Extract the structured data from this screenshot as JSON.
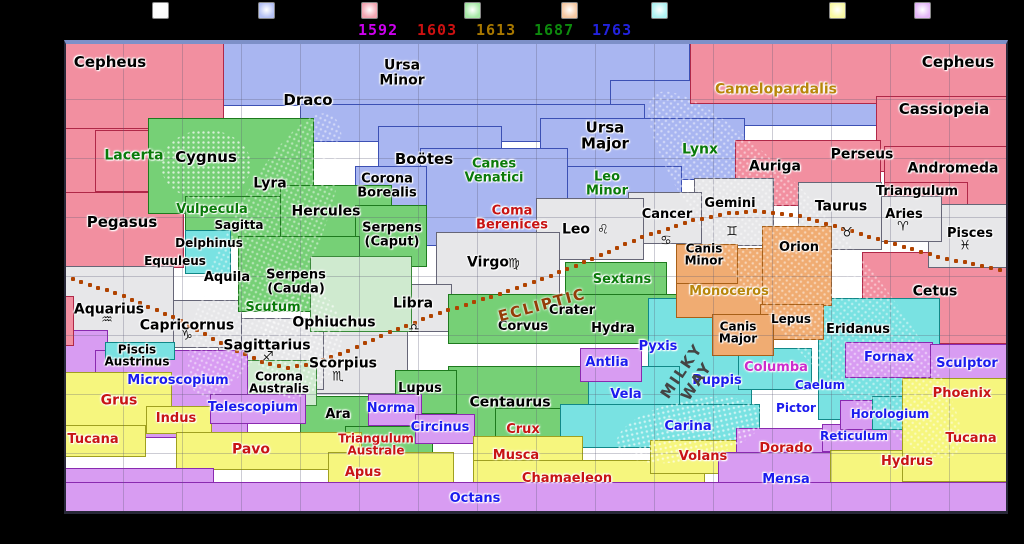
{
  "legend": {
    "swatches": [
      {
        "name": "zodiac-family",
        "color": "#fbfbfb",
        "x": 152
      },
      {
        "name": "ursa-major-family",
        "color": "#b4c0f4",
        "x": 258
      },
      {
        "name": "perseus-family",
        "color": "#f4a6b2",
        "x": 361
      },
      {
        "name": "hercules-family",
        "color": "#a6e8a6",
        "x": 464
      },
      {
        "name": "orion-family",
        "color": "#f6c8a2",
        "x": 561
      },
      {
        "name": "heavenly-waters-family",
        "color": "#aef2f2",
        "x": 651
      },
      {
        "name": "bayer-family",
        "color": "#f8f8a2",
        "x": 829
      },
      {
        "name": "lacaille-family",
        "color": "#e4b6f8",
        "x": 914
      }
    ],
    "years": [
      {
        "text": "1592",
        "color": "#cc00ee",
        "x": 358
      },
      {
        "text": "1603",
        "color": "#cc1111",
        "x": 417
      },
      {
        "text": "1613",
        "color": "#a87800",
        "x": 476
      },
      {
        "text": "1687",
        "color": "#0d8a0d",
        "x": 534
      },
      {
        "text": "1763",
        "color": "#2222dd",
        "x": 592
      }
    ]
  },
  "map": {
    "x": 64,
    "y": 40,
    "w": 944,
    "h": 474,
    "families": {
      "zodiac": {
        "fill": "#e7e7e9",
        "border": "#666677"
      },
      "ursa": {
        "fill": "#a9b6f1",
        "border": "#3c50b4"
      },
      "perseus": {
        "fill": "#f28fa0",
        "border": "#b02848"
      },
      "hercules": {
        "fill": "#76d076",
        "border": "#1e7a1e"
      },
      "herc2": {
        "fill": "#cfeacf",
        "border": "#3a8a3a"
      },
      "waters": {
        "fill": "#79e2e2",
        "border": "#118888"
      },
      "orion": {
        "fill": "#f0ac72",
        "border": "#a86018"
      },
      "bayer": {
        "fill": "#f6f67e",
        "border": "#a0a020"
      },
      "lacaille": {
        "fill": "#d89cf2",
        "border": "#8a2ab0"
      }
    },
    "label_colors": {
      "a": "#000000",
      "g": "#0a7a0a",
      "r": "#c81414",
      "t": "#b8860b",
      "m": "#cc2ccc",
      "b": "#1b1bee"
    },
    "regions": [
      [
        "ursa",
        222,
        42,
        468,
        64
      ],
      [
        "ursa",
        610,
        80,
        268,
        46
      ],
      [
        "ursa",
        300,
        104,
        345,
        38
      ],
      [
        "ursa",
        540,
        118,
        205,
        62
      ],
      [
        "ursa",
        560,
        166,
        122,
        44
      ],
      [
        "ursa",
        378,
        126,
        124,
        62
      ],
      [
        "ursa",
        420,
        148,
        148,
        98
      ],
      [
        "ursa",
        355,
        166,
        72,
        40
      ],
      [
        "perseus",
        64,
        42,
        160,
        94
      ],
      [
        "perseus",
        690,
        42,
        318,
        62
      ],
      [
        "perseus",
        64,
        128,
        96,
        74
      ],
      [
        "perseus",
        95,
        130,
        126,
        62
      ],
      [
        "perseus",
        64,
        192,
        120,
        76
      ],
      [
        "perseus",
        876,
        96,
        132,
        76
      ],
      [
        "perseus",
        735,
        140,
        146,
        66
      ],
      [
        "perseus",
        884,
        146,
        124,
        62
      ],
      [
        "perseus",
        884,
        182,
        84,
        28
      ],
      [
        "perseus",
        862,
        252,
        146,
        92
      ],
      [
        "zodiac",
        928,
        204,
        80,
        64
      ],
      [
        "zodiac",
        868,
        196,
        74,
        46
      ],
      [
        "zodiac",
        798,
        182,
        84,
        68
      ],
      [
        "zodiac",
        694,
        178,
        80,
        68
      ],
      [
        "zodiac",
        628,
        192,
        74,
        52
      ],
      [
        "zodiac",
        536,
        198,
        108,
        62
      ],
      [
        "zodiac",
        436,
        232,
        124,
        68
      ],
      [
        "zodiac",
        378,
        284,
        74,
        48
      ],
      [
        "zodiac",
        298,
        330,
        110,
        64
      ],
      [
        "zodiac",
        218,
        318,
        106,
        72
      ],
      [
        "zodiac",
        112,
        300,
        130,
        48
      ],
      [
        "zodiac",
        64,
        266,
        110,
        78
      ],
      [
        "hercules",
        148,
        118,
        166,
        96
      ],
      [
        "hercules",
        185,
        196,
        118,
        50
      ],
      [
        "hercules",
        280,
        185,
        112,
        96
      ],
      [
        "hercules",
        355,
        205,
        72,
        62
      ],
      [
        "hercules",
        238,
        236,
        122,
        76
      ],
      [
        "herc2",
        310,
        256,
        102,
        76
      ],
      [
        "hercules",
        565,
        262,
        102,
        42
      ],
      [
        "hercules",
        448,
        294,
        232,
        50
      ],
      [
        "hercules",
        448,
        366,
        170,
        72
      ],
      [
        "hercules",
        395,
        370,
        62,
        44
      ],
      [
        "hercules",
        300,
        396,
        82,
        54
      ],
      [
        "hercules",
        345,
        426,
        88,
        44
      ],
      [
        "herc2",
        245,
        360,
        72,
        46
      ],
      [
        "hercules",
        495,
        408,
        70,
        34
      ],
      [
        "waters",
        185,
        230,
        46,
        44
      ],
      [
        "waters",
        818,
        298,
        122,
        122
      ],
      [
        "waters",
        648,
        298,
        104,
        112
      ],
      [
        "waters",
        588,
        366,
        92,
        62
      ],
      [
        "waters",
        560,
        404,
        200,
        44
      ],
      [
        "waters",
        738,
        348,
        74,
        42
      ],
      [
        "orion",
        676,
        248,
        106,
        70
      ],
      [
        "orion",
        762,
        226,
        70,
        80
      ],
      [
        "orion",
        676,
        244,
        62,
        40
      ],
      [
        "orion",
        760,
        304,
        64,
        36
      ],
      [
        "orion",
        712,
        314,
        62,
        42
      ],
      [
        "lacaille",
        64,
        330,
        44,
        108
      ],
      [
        "lacaille",
        95,
        350,
        153,
        88
      ],
      [
        "waters",
        105,
        342,
        70,
        18
      ],
      [
        "bayer",
        64,
        372,
        108,
        55
      ],
      [
        "bayer",
        146,
        406,
        66,
        28
      ],
      [
        "bayer",
        64,
        425,
        82,
        32
      ],
      [
        "bayer",
        176,
        432,
        186,
        38
      ],
      [
        "lacaille",
        210,
        394,
        96,
        30
      ],
      [
        "lacaille",
        368,
        394,
        54,
        32
      ],
      [
        "lacaille",
        415,
        414,
        60,
        30
      ],
      [
        "bayer",
        328,
        452,
        126,
        38
      ],
      [
        "bayer",
        473,
        436,
        110,
        34
      ],
      [
        "bayer",
        473,
        460,
        232,
        28
      ],
      [
        "bayer",
        650,
        440,
        100,
        34
      ],
      [
        "lacaille",
        580,
        348,
        62,
        34
      ],
      [
        "lacaille",
        736,
        428,
        96,
        32
      ],
      [
        "lacaille",
        718,
        452,
        140,
        40
      ],
      [
        "lacaille",
        822,
        424,
        90,
        28
      ],
      [
        "bayer",
        830,
        450,
        105,
        34
      ],
      [
        "lacaille",
        840,
        400,
        118,
        30
      ],
      [
        "waters",
        872,
        396,
        32,
        34
      ],
      [
        "lacaille",
        845,
        342,
        88,
        36
      ],
      [
        "lacaille",
        930,
        344,
        78,
        36
      ],
      [
        "bayer",
        902,
        378,
        106,
        104
      ],
      [
        "lacaille",
        64,
        468,
        150,
        44
      ],
      [
        "lacaille",
        64,
        482,
        944,
        30
      ],
      [
        "perseus",
        64,
        296,
        10,
        50
      ]
    ],
    "labels": [
      [
        "Cepheus",
        110,
        63,
        "a",
        15
      ],
      [
        "Ursa\nMinor",
        402,
        73,
        "a",
        14
      ],
      [
        "Draco",
        308,
        101,
        "a",
        15
      ],
      [
        "Camelopardalis",
        776,
        90,
        "t",
        14
      ],
      [
        "Cepheus",
        958,
        63,
        "a",
        15
      ],
      [
        "Cassiopeia",
        944,
        110,
        "a",
        15
      ],
      [
        "Lacerta",
        134,
        156,
        "g",
        14
      ],
      [
        "Cygnus",
        206,
        158,
        "a",
        15
      ],
      [
        "Lyra",
        270,
        184,
        "a",
        14
      ],
      [
        "Boötes",
        424,
        160,
        "a",
        15
      ],
      [
        "Canes\nVenatici",
        494,
        171,
        "g",
        13
      ],
      [
        "Ursa\nMajor",
        605,
        136,
        "a",
        15
      ],
      [
        "Leo\nMinor",
        607,
        184,
        "g",
        13
      ],
      [
        "Lynx",
        700,
        150,
        "g",
        14
      ],
      [
        "Auriga",
        775,
        167,
        "a",
        14
      ],
      [
        "Perseus",
        862,
        155,
        "a",
        14
      ],
      [
        "Andromeda",
        953,
        169,
        "a",
        14
      ],
      [
        "Triangulum",
        917,
        192,
        "a",
        13
      ],
      [
        "Corona\nBorealis",
        387,
        186,
        "a",
        13
      ],
      [
        "Hercules",
        326,
        212,
        "a",
        14
      ],
      [
        "Vulpecula",
        212,
        210,
        "g",
        13
      ],
      [
        "Sagitta",
        239,
        225,
        "a",
        12
      ],
      [
        "Delphinus",
        209,
        243,
        "a",
        12
      ],
      [
        "Equuleus",
        175,
        261,
        "a",
        12
      ],
      [
        "Pegasus",
        122,
        223,
        "a",
        15
      ],
      [
        "Serpens\n(Caput)",
        392,
        235,
        "a",
        13
      ],
      [
        "Coma\nBerenices",
        512,
        218,
        "r",
        13
      ],
      [
        "Aquila",
        227,
        278,
        "a",
        13
      ],
      [
        "Serpens\n(Cauda)",
        296,
        282,
        "a",
        13
      ],
      [
        "Scutum",
        273,
        308,
        "g",
        13
      ],
      [
        "Ophiuchus",
        334,
        323,
        "a",
        14
      ],
      [
        "Virgo",
        488,
        263,
        "a",
        14
      ],
      [
        "Leo",
        576,
        230,
        "a",
        14
      ],
      [
        "Cancer",
        667,
        215,
        "a",
        13
      ],
      [
        "Gemini",
        730,
        204,
        "a",
        13
      ],
      [
        "Taurus",
        841,
        207,
        "a",
        14
      ],
      [
        "Aries",
        904,
        215,
        "a",
        13
      ],
      [
        "Pisces",
        970,
        234,
        "a",
        13
      ],
      [
        "Cetus",
        935,
        292,
        "a",
        14
      ],
      [
        "Orion",
        799,
        248,
        "a",
        13
      ],
      [
        "Canis\nMinor",
        704,
        255,
        "a",
        12
      ],
      [
        "Monoceros",
        729,
        292,
        "t",
        13
      ],
      [
        "Canis\nMajor",
        738,
        333,
        "a",
        12
      ],
      [
        "Lepus",
        791,
        319,
        "a",
        12
      ],
      [
        "Eridanus",
        858,
        330,
        "a",
        13
      ],
      [
        "Sextans",
        622,
        280,
        "g",
        13
      ],
      [
        "Crater",
        572,
        311,
        "a",
        13
      ],
      [
        "Corvus",
        523,
        327,
        "a",
        13
      ],
      [
        "Hydra",
        613,
        329,
        "a",
        13
      ],
      [
        "Libra",
        413,
        304,
        "a",
        14
      ],
      [
        "Scorpius",
        343,
        364,
        "a",
        14
      ],
      [
        "Sagittarius",
        267,
        346,
        "a",
        14
      ],
      [
        "Capricornus",
        187,
        326,
        "a",
        14
      ],
      [
        "Aquarius",
        109,
        310,
        "a",
        14
      ],
      [
        "Piscis\nAustrinus",
        137,
        356,
        "a",
        12
      ],
      [
        "Corona\nAustralis",
        279,
        383,
        "a",
        12
      ],
      [
        "Microscopium",
        178,
        381,
        "b",
        13
      ],
      [
        "Grus",
        119,
        401,
        "r",
        14
      ],
      [
        "Indus",
        176,
        419,
        "r",
        13
      ],
      [
        "Tucana",
        93,
        440,
        "r",
        13
      ],
      [
        "Pavo",
        251,
        450,
        "r",
        14
      ],
      [
        "Telescopium",
        253,
        408,
        "b",
        13
      ],
      [
        "Ara",
        338,
        415,
        "a",
        13
      ],
      [
        "Norma",
        391,
        409,
        "b",
        13
      ],
      [
        "Circinus",
        440,
        428,
        "b",
        13
      ],
      [
        "Lupus",
        420,
        389,
        "a",
        13
      ],
      [
        "Centaurus",
        510,
        403,
        "a",
        14
      ],
      [
        "Crux",
        523,
        430,
        "r",
        13
      ],
      [
        "Musca",
        516,
        456,
        "r",
        13
      ],
      [
        "Triangulum\nAustrale",
        376,
        445,
        "r",
        12
      ],
      [
        "Apus",
        363,
        473,
        "r",
        13
      ],
      [
        "Chamaeleon",
        567,
        479,
        "r",
        13
      ],
      [
        "Octans",
        475,
        499,
        "b",
        13
      ],
      [
        "Antlia",
        607,
        363,
        "b",
        13
      ],
      [
        "Pyxis",
        658,
        347,
        "b",
        13
      ],
      [
        "Puppis",
        717,
        381,
        "b",
        13
      ],
      [
        "Vela",
        626,
        395,
        "b",
        13
      ],
      [
        "Carina",
        688,
        427,
        "b",
        13
      ],
      [
        "Volans",
        703,
        457,
        "r",
        13
      ],
      [
        "Columba",
        776,
        368,
        "m",
        13
      ],
      [
        "Dorado",
        786,
        449,
        "r",
        13
      ],
      [
        "Mensa",
        786,
        480,
        "b",
        13
      ],
      [
        "Reticulum",
        854,
        436,
        "b",
        12
      ],
      [
        "Horologium",
        890,
        414,
        "b",
        12
      ],
      [
        "Pictor",
        796,
        408,
        "b",
        12
      ],
      [
        "Caelum",
        820,
        385,
        "b",
        12
      ],
      [
        "Fornax",
        889,
        358,
        "b",
        13
      ],
      [
        "Sculptor",
        967,
        364,
        "b",
        13
      ],
      [
        "Phoenix",
        962,
        394,
        "r",
        13
      ],
      [
        "Tucana",
        971,
        439,
        "r",
        13
      ],
      [
        "Hydrus",
        907,
        462,
        "r",
        13
      ]
    ],
    "zodiac_symbols": [
      [
        "♈",
        903,
        227
      ],
      [
        "♉",
        847,
        233
      ],
      [
        "♊",
        732,
        232
      ],
      [
        "♋",
        666,
        241
      ],
      [
        "♌",
        603,
        230
      ],
      [
        "♍",
        514,
        264
      ],
      [
        "♎",
        414,
        329
      ],
      [
        "♏",
        338,
        377
      ],
      [
        "♐",
        268,
        357
      ],
      [
        "♑",
        187,
        336
      ],
      [
        "♒",
        107,
        320
      ],
      [
        "♓",
        965,
        246
      ]
    ],
    "ecliptic": {
      "label": "ECLIPTIC",
      "label_color": "#943c08",
      "dot_color": "#b04300",
      "points": [
        [
          64,
          276
        ],
        [
          120,
          295
        ],
        [
          175,
          318
        ],
        [
          225,
          345
        ],
        [
          262,
          362
        ],
        [
          288,
          368
        ],
        [
          315,
          363
        ],
        [
          350,
          350
        ],
        [
          395,
          330
        ],
        [
          440,
          313
        ],
        [
          490,
          297
        ],
        [
          540,
          280
        ],
        [
          590,
          260
        ],
        [
          640,
          238
        ],
        [
          690,
          221
        ],
        [
          730,
          213
        ],
        [
          760,
          211
        ],
        [
          800,
          216
        ],
        [
          845,
          229
        ],
        [
          890,
          243
        ],
        [
          940,
          257
        ],
        [
          985,
          267
        ],
        [
          1008,
          272
        ]
      ]
    },
    "milkyway": {
      "label": "MILKY WAY",
      "color": "#444444"
    }
  }
}
